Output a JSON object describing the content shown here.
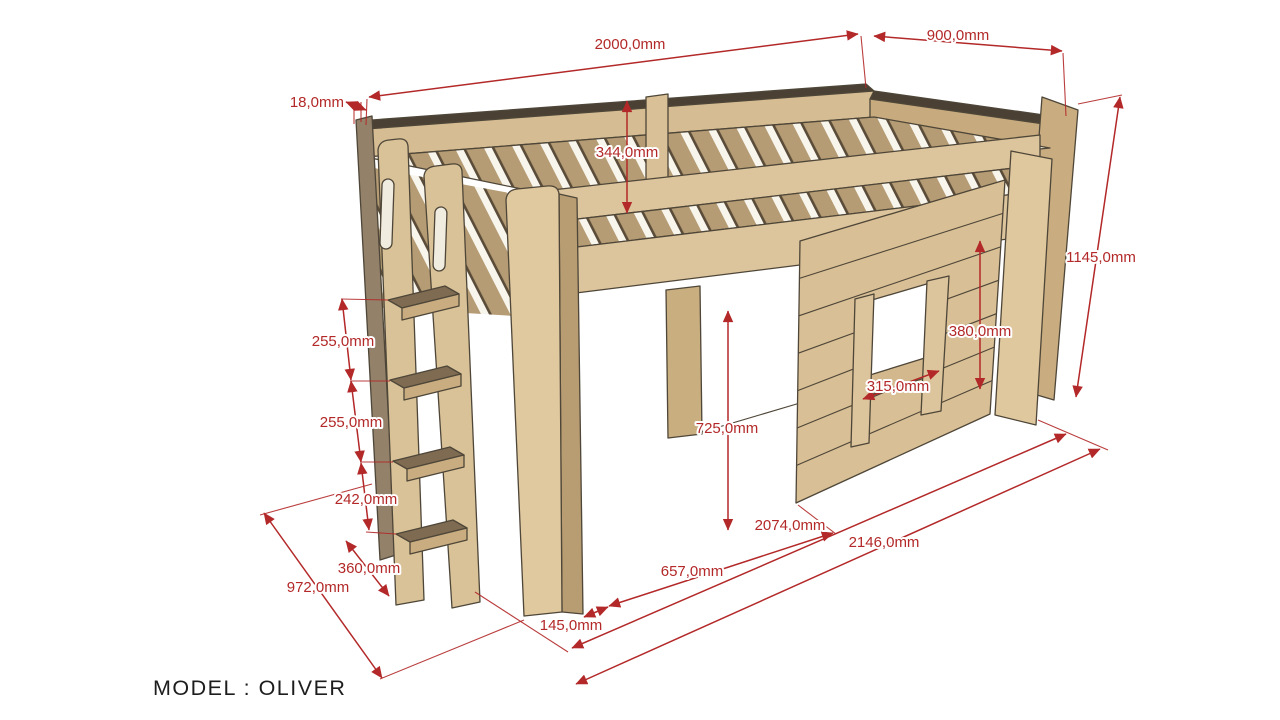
{
  "drawing": {
    "title": "Loft bed technical drawing",
    "model_label": "MODEL : OLIVER",
    "unit": "mm",
    "colors": {
      "dimension_red": "#b32828",
      "wood_light": "#dcc49c",
      "wood_mid": "#c9ad80",
      "wood_dark_edge": "#93816a",
      "outline": "#4e4638",
      "background": "#ffffff"
    },
    "dimensions": {
      "bed_length_top": "2000,0mm",
      "bed_width_top": "900,0mm",
      "panel_thickness": "18,0mm",
      "guardrail_height": "344,0mm",
      "overall_height": "1145,0mm",
      "shelf_gap_top": "255,0mm",
      "shelf_gap_middle": "255,0mm",
      "shelf_height_bottom": "242,0mm",
      "shelf_depth": "360,0mm",
      "overall_depth": "972,0mm",
      "underbed_opening": "657,0mm",
      "leg_depth": "145,0mm",
      "underbed_clearance": "725,0mm",
      "window_width": "315,0mm",
      "window_height": "380,0mm",
      "front_length_inner": "2074,0mm",
      "front_length_overall": "2146,0mm"
    }
  }
}
